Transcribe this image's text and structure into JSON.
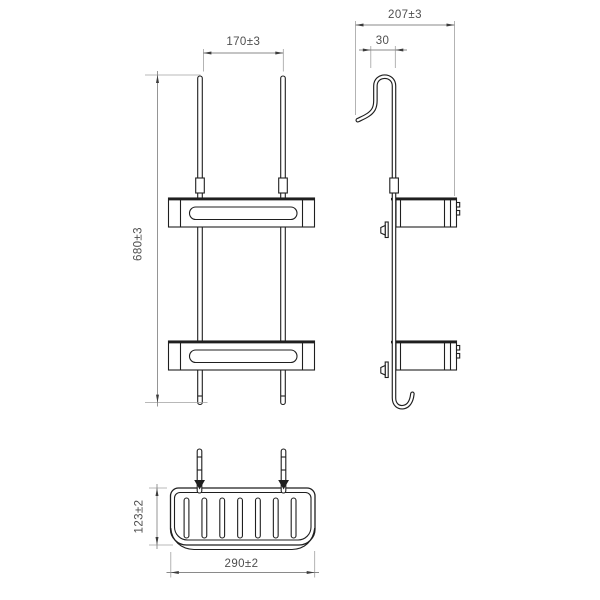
{
  "colors": {
    "background": "#ffffff",
    "outline": "#1f1f1f",
    "dim_line": "#8a8a8a",
    "ext_line": "#a0a0a0",
    "arrow": "#3c3c3c",
    "dim_text": "#4f4f4f"
  },
  "views": {
    "front": {
      "dims": {
        "hook_spacing": "170±3",
        "overall_height": "680±3"
      }
    },
    "side": {
      "dims": {
        "overall_depth": "207±3",
        "hook_opening": "30"
      }
    },
    "bottom": {
      "dims": {
        "basket_depth": "123±2",
        "basket_width": "290±2"
      }
    }
  }
}
